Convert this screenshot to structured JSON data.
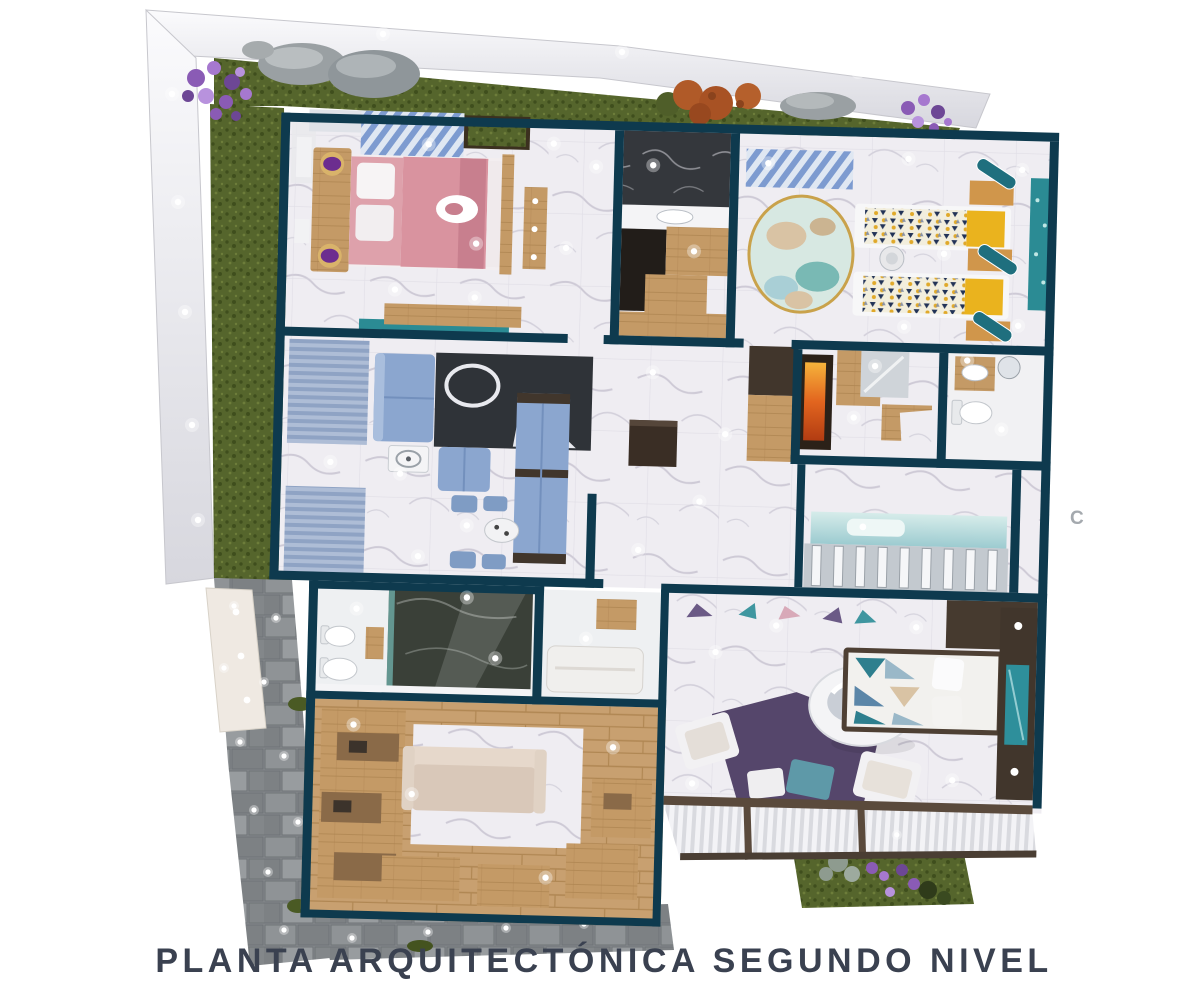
{
  "caption": "PLANTA ARQUITECTÓNICA SEGUNDO NIVEL",
  "watermark": "C",
  "palette": {
    "background": "#ffffff",
    "band": "#ebebf0",
    "wall": "#0e3a4e",
    "marble": "#efedf2",
    "marbleVein": "#b7b3c3",
    "marbleDark": "#34373c",
    "grass": "#55652c",
    "grassDark": "#3f4e1d",
    "stone": "#85898c",
    "stoneDark": "#6f7477",
    "wood": "#c49a66",
    "woodDark": "#ad834f",
    "cabinetBrown": "#41362c",
    "pink": "#d9939f",
    "pinkDark": "#c87f8e",
    "blue": "#8ba6cf",
    "teal": "#2b8b94",
    "tealDark": "#1f6f7e",
    "yellow": "#eab31e",
    "purpleRug": "#55466b",
    "purpleFlower": "#9a6fc2",
    "orange": "#e2651f",
    "beige": "#dfd0c2",
    "charcoal": "#2f3338",
    "caption": "#3a4150"
  }
}
